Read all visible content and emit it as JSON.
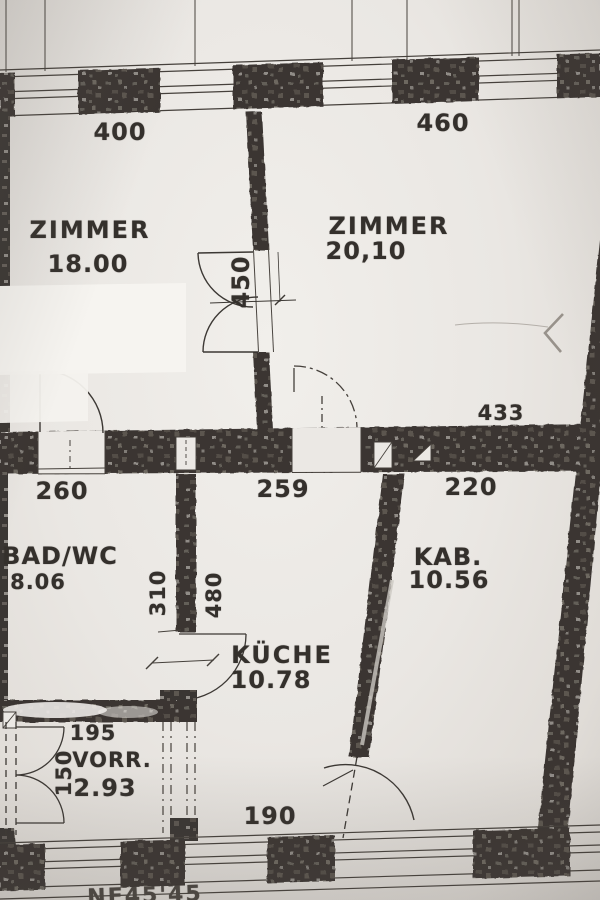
{
  "plan": {
    "rooms": {
      "zimmer1": {
        "name": "ZIMMER",
        "area": "18.00"
      },
      "zimmer2": {
        "name": "ZIMMER",
        "area": "20,10"
      },
      "bad": {
        "name": "BAD/WC",
        "area": "8.06"
      },
      "kueche": {
        "name": "KÜCHE",
        "area": "10.78"
      },
      "kab": {
        "name": "KAB.",
        "area": "10.56"
      },
      "vorr": {
        "name": "VORR.",
        "area": "2.93"
      }
    },
    "dimensions": {
      "win_left": "400",
      "win_right": "460",
      "door_double": "450",
      "kab_top": "433",
      "bad_width": "260",
      "kueche_width": "259",
      "kab_width": "220",
      "wall_310": "310",
      "wall_480": "480",
      "vorr_width": "195",
      "vorr_door": "150",
      "kueche_bottom": "190",
      "bottom_note": "NF45'45"
    },
    "colors": {
      "paper": "#eae7e3",
      "ink": "#3a3633"
    }
  }
}
